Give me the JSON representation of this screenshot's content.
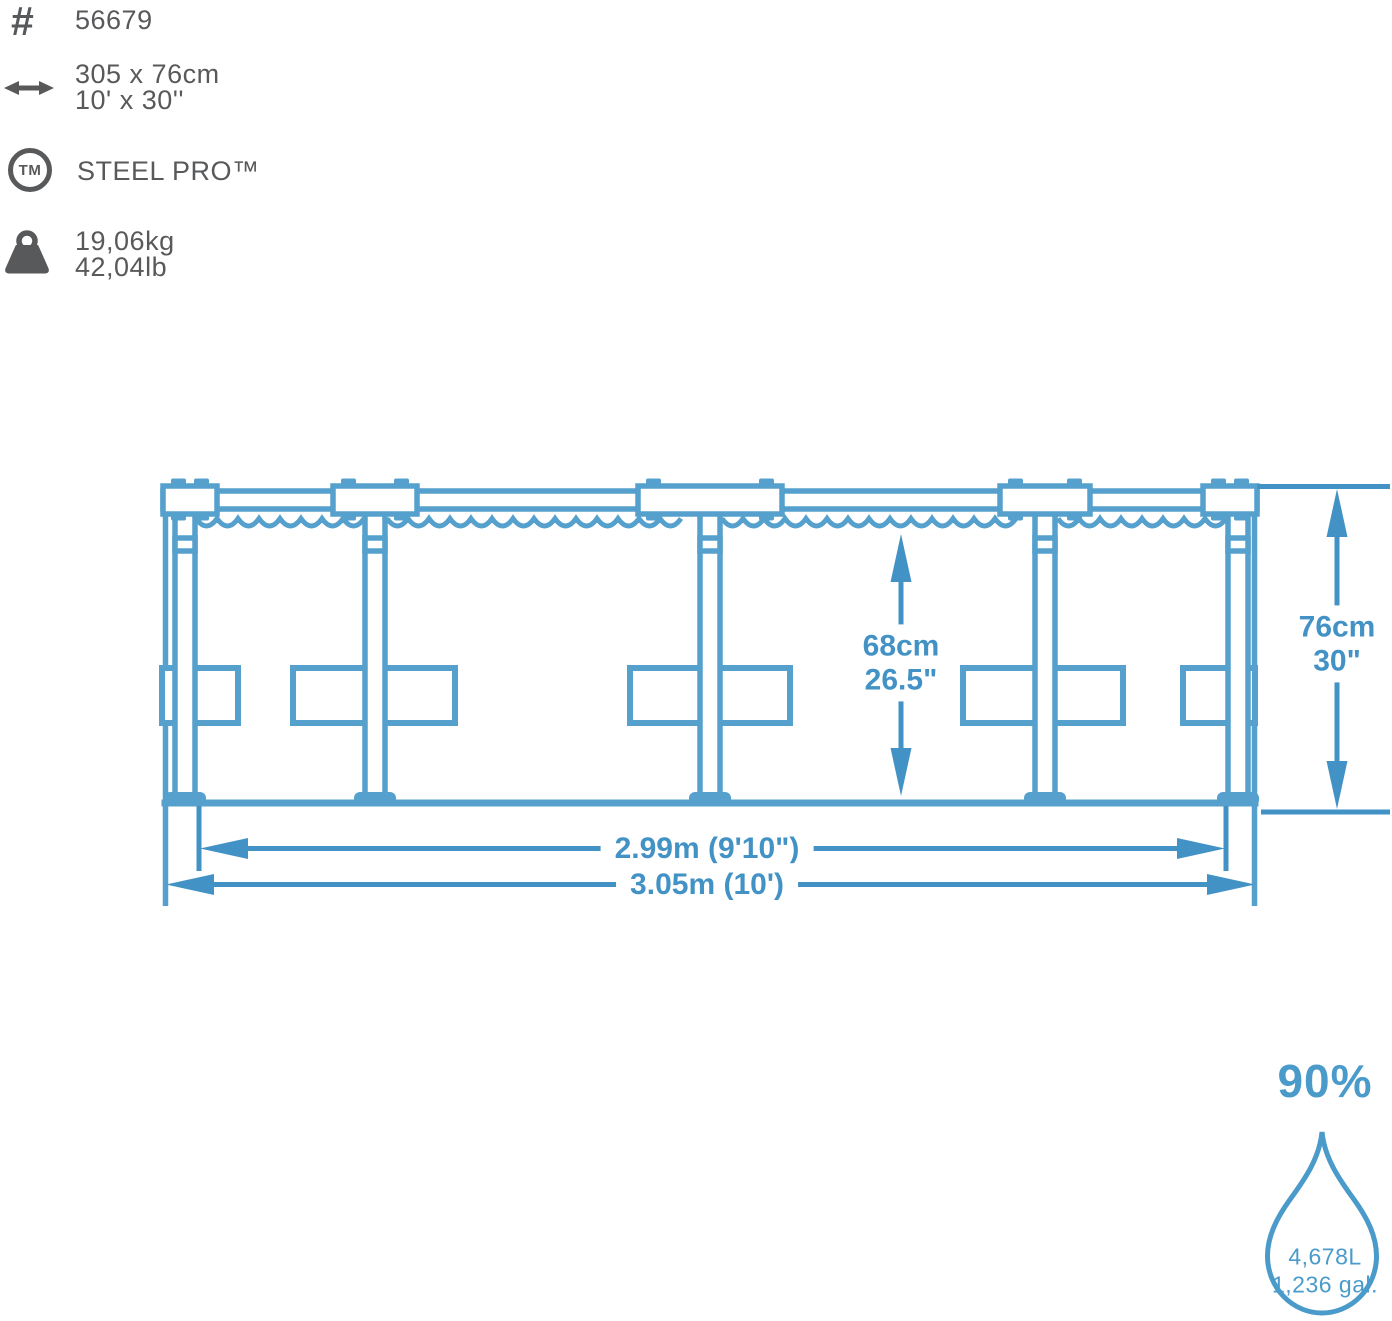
{
  "specs": {
    "hash_symbol": "#",
    "item_number": "56679",
    "size_metric": "305 x 76cm",
    "size_imperial": "10' x 30''",
    "tm_label": "TM",
    "product_line": "STEEL PRO™",
    "weight_metric": "19,06kg",
    "weight_imperial": "42,04lb"
  },
  "dimensions": {
    "water_depth_metric": "68cm",
    "water_depth_imperial": "26.5\"",
    "wall_height_metric": "76cm",
    "wall_height_imperial": "30\"",
    "inner_diameter": "2.99m (9'10\")",
    "outer_diameter": "3.05m (10')"
  },
  "capacity": {
    "fill_level": "90%",
    "volume_liters": "4,678L",
    "volume_gallons": "1,236 gal."
  },
  "colors": {
    "line_blue": "#55a0cc",
    "dim_blue": "#4392c6",
    "accent_blue": "#4a9bca",
    "icon_gray": "#58595b"
  }
}
